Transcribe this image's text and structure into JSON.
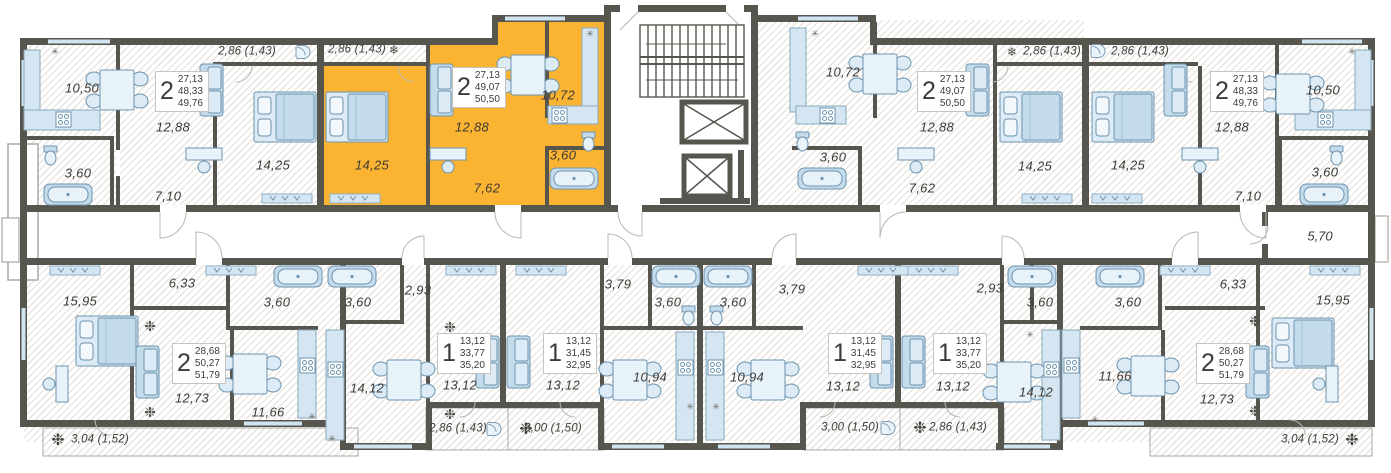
{
  "plan_title": "residential floor plan",
  "colors": {
    "wall": "#57564e",
    "highlight_fill": "#fbb431",
    "furniture_fill": "#dcebf5",
    "furniture_stroke": "#6d93ae",
    "floor_hatch": "#e2dfda",
    "label_text": "#3d3b37",
    "badge_border": "#c6c4c0"
  },
  "corridor": {
    "labels": [
      {
        "text": "5,70",
        "x": 1320,
        "y": 236
      }
    ]
  },
  "core": {
    "stairs": "staircase",
    "elevators": 2
  },
  "apartments": [
    {
      "id": "top-left",
      "rooms_count": "2",
      "highlighted": false,
      "badge": {
        "rooms": "2",
        "living": "27,13",
        "area": "48,33",
        "total": "49,76",
        "x": 155,
        "y": 71
      },
      "room_labels": [
        {
          "text": "10,50",
          "x": 82,
          "y": 88
        },
        {
          "text": "12,88",
          "x": 173,
          "y": 127
        },
        {
          "text": "14,25",
          "x": 273,
          "y": 165
        },
        {
          "text": "7,10",
          "x": 168,
          "y": 196
        },
        {
          "text": "3,60",
          "x": 78,
          "y": 173
        }
      ],
      "balconies": [
        {
          "text": "2,86 (1,43)",
          "x": 247,
          "y": 52,
          "icon": "ac-unit",
          "icon_x": 303,
          "icon_y": 52
        }
      ]
    },
    {
      "id": "top-mid-left-highlighted",
      "rooms_count": "2",
      "highlighted": true,
      "badge": {
        "rooms": "2",
        "living": "27,13",
        "area": "49,07",
        "total": "50,50",
        "x": 452,
        "y": 67
      },
      "room_labels": [
        {
          "text": "14,25",
          "x": 372,
          "y": 165
        },
        {
          "text": "12,88",
          "x": 472,
          "y": 127
        },
        {
          "text": "10,72",
          "x": 558,
          "y": 95
        },
        {
          "text": "7,62",
          "x": 487,
          "y": 188
        },
        {
          "text": "3,60",
          "x": 563,
          "y": 155
        }
      ],
      "balconies": [
        {
          "text": "2,86 (1,43)",
          "x": 357,
          "y": 50,
          "icon": "snowflake",
          "icon_x": 394,
          "icon_y": 50
        }
      ]
    },
    {
      "id": "top-mid-right",
      "rooms_count": "2",
      "highlighted": false,
      "badge": {
        "rooms": "2",
        "living": "27,13",
        "area": "49,07",
        "total": "50,50",
        "x": 917,
        "y": 71
      },
      "room_labels": [
        {
          "text": "10,72",
          "x": 843,
          "y": 72
        },
        {
          "text": "12,88",
          "x": 937,
          "y": 127
        },
        {
          "text": "14,25",
          "x": 1035,
          "y": 166
        },
        {
          "text": "7,62",
          "x": 922,
          "y": 188
        },
        {
          "text": "3,60",
          "x": 833,
          "y": 157
        }
      ],
      "balconies": [
        {
          "text": "2,86 (1,43)",
          "x": 1052,
          "y": 52,
          "icon": "snowflake",
          "icon_x": 1012,
          "icon_y": 52
        }
      ]
    },
    {
      "id": "top-right",
      "rooms_count": "2",
      "highlighted": false,
      "badge": {
        "rooms": "2",
        "living": "27,13",
        "area": "48,33",
        "total": "49,76",
        "x": 1210,
        "y": 71
      },
      "room_labels": [
        {
          "text": "14,25",
          "x": 1128,
          "y": 165
        },
        {
          "text": "12,88",
          "x": 1232,
          "y": 127
        },
        {
          "text": "10,50",
          "x": 1323,
          "y": 90
        },
        {
          "text": "7,10",
          "x": 1248,
          "y": 196
        },
        {
          "text": "3,60",
          "x": 1325,
          "y": 172
        }
      ],
      "balconies": [
        {
          "text": "2,86 (1,43)",
          "x": 1140,
          "y": 52,
          "icon": "ac-unit",
          "icon_x": 1098,
          "icon_y": 51
        }
      ]
    },
    {
      "id": "bottom-left",
      "rooms_count": "2",
      "highlighted": false,
      "badge": {
        "rooms": "2",
        "living": "28,68",
        "area": "50,27",
        "total": "51,79",
        "x": 172,
        "y": 343
      },
      "room_labels": [
        {
          "text": "15,95",
          "x": 80,
          "y": 301
        },
        {
          "text": "6,33",
          "x": 182,
          "y": 283
        },
        {
          "text": "3,60",
          "x": 277,
          "y": 302
        },
        {
          "text": "12,73",
          "x": 192,
          "y": 398
        },
        {
          "text": "11,66",
          "x": 268,
          "y": 412
        }
      ],
      "balconies": [
        {
          "text": "3,04 (1,52)",
          "x": 100,
          "y": 440,
          "icon": "snow-cluster",
          "icon_x": 58,
          "icon_y": 440
        }
      ]
    },
    {
      "id": "bottom-mid-left-a",
      "rooms_count": "1",
      "highlighted": false,
      "badge": {
        "rooms": "1",
        "living": "13,12",
        "area": "33,77",
        "total": "35,20",
        "x": 437,
        "y": 333
      },
      "room_labels": [
        {
          "text": "3,60",
          "x": 358,
          "y": 302
        },
        {
          "text": "2,93",
          "x": 418,
          "y": 290
        },
        {
          "text": "14,12",
          "x": 367,
          "y": 388
        },
        {
          "text": "13,12",
          "x": 460,
          "y": 385
        }
      ],
      "balconies": [
        {
          "text": "2,86 (1,43)",
          "x": 458,
          "y": 429,
          "icon": "ac-unit",
          "icon_x": 494,
          "icon_y": 429
        }
      ]
    },
    {
      "id": "bottom-mid-left-b",
      "rooms_count": "1",
      "highlighted": false,
      "badge": {
        "rooms": "1",
        "living": "13,12",
        "area": "31,45",
        "total": "32,95",
        "x": 543,
        "y": 333
      },
      "room_labels": [
        {
          "text": "13,12",
          "x": 563,
          "y": 385
        },
        {
          "text": "3,79",
          "x": 618,
          "y": 284
        },
        {
          "text": "3,60",
          "x": 668,
          "y": 302
        },
        {
          "text": "10,94",
          "x": 650,
          "y": 377
        }
      ],
      "balconies": [
        {
          "text": "3,00 (1,50)",
          "x": 553,
          "y": 429,
          "icon": "snow-cluster",
          "icon_x": 526,
          "icon_y": 429
        }
      ]
    },
    {
      "id": "bottom-mid-right-b",
      "rooms_count": "1",
      "highlighted": false,
      "badge": {
        "rooms": "1",
        "living": "13,12",
        "area": "31,45",
        "total": "32,95",
        "x": 828,
        "y": 333
      },
      "room_labels": [
        {
          "text": "10,94",
          "x": 747,
          "y": 377
        },
        {
          "text": "3,60",
          "x": 733,
          "y": 302
        },
        {
          "text": "3,79",
          "x": 792,
          "y": 289
        },
        {
          "text": "13,12",
          "x": 843,
          "y": 386
        }
      ],
      "balconies": [
        {
          "text": "3,00 (1,50)",
          "x": 850,
          "y": 428,
          "icon": "ac-unit",
          "icon_x": 888,
          "icon_y": 428
        }
      ]
    },
    {
      "id": "bottom-mid-right-a",
      "rooms_count": "1",
      "highlighted": false,
      "badge": {
        "rooms": "1",
        "living": "13,12",
        "area": "33,77",
        "total": "35,20",
        "x": 933,
        "y": 333
      },
      "room_labels": [
        {
          "text": "13,12",
          "x": 953,
          "y": 386
        },
        {
          "text": "2,93",
          "x": 990,
          "y": 288
        },
        {
          "text": "3,60",
          "x": 1040,
          "y": 302
        },
        {
          "text": "14,12",
          "x": 1036,
          "y": 392
        }
      ],
      "balconies": [
        {
          "text": "2,86 (1,43)",
          "x": 958,
          "y": 428,
          "icon": "snow-cluster",
          "icon_x": 920,
          "icon_y": 428
        }
      ]
    },
    {
      "id": "bottom-right",
      "rooms_count": "2",
      "highlighted": false,
      "badge": {
        "rooms": "2",
        "living": "28,68",
        "area": "50,27",
        "total": "51,79",
        "x": 1196,
        "y": 343
      },
      "room_labels": [
        {
          "text": "3,60",
          "x": 1128,
          "y": 302
        },
        {
          "text": "6,33",
          "x": 1233,
          "y": 284
        },
        {
          "text": "15,95",
          "x": 1333,
          "y": 300
        },
        {
          "text": "12,73",
          "x": 1217,
          "y": 399
        },
        {
          "text": "11,66",
          "x": 1115,
          "y": 376
        }
      ],
      "balconies": [
        {
          "text": "3,04 (1,52)",
          "x": 1310,
          "y": 440,
          "icon": "snow-cluster",
          "icon_x": 1352,
          "icon_y": 440
        }
      ]
    }
  ],
  "decor_icons": [
    {
      "x": 150,
      "y": 327
    },
    {
      "x": 150,
      "y": 413
    },
    {
      "x": 450,
      "y": 328
    },
    {
      "x": 450,
      "y": 415
    },
    {
      "x": 1255,
      "y": 322
    },
    {
      "x": 1255,
      "y": 412
    }
  ],
  "vent_icons": [
    {
      "x": 55,
      "y": 53
    },
    {
      "x": 590,
      "y": 35
    },
    {
      "x": 815,
      "y": 35
    },
    {
      "x": 1352,
      "y": 53
    },
    {
      "x": 312,
      "y": 418
    },
    {
      "x": 332,
      "y": 440
    },
    {
      "x": 690,
      "y": 408
    },
    {
      "x": 716,
      "y": 408
    },
    {
      "x": 1030,
      "y": 336
    },
    {
      "x": 1095,
      "y": 421
    }
  ]
}
